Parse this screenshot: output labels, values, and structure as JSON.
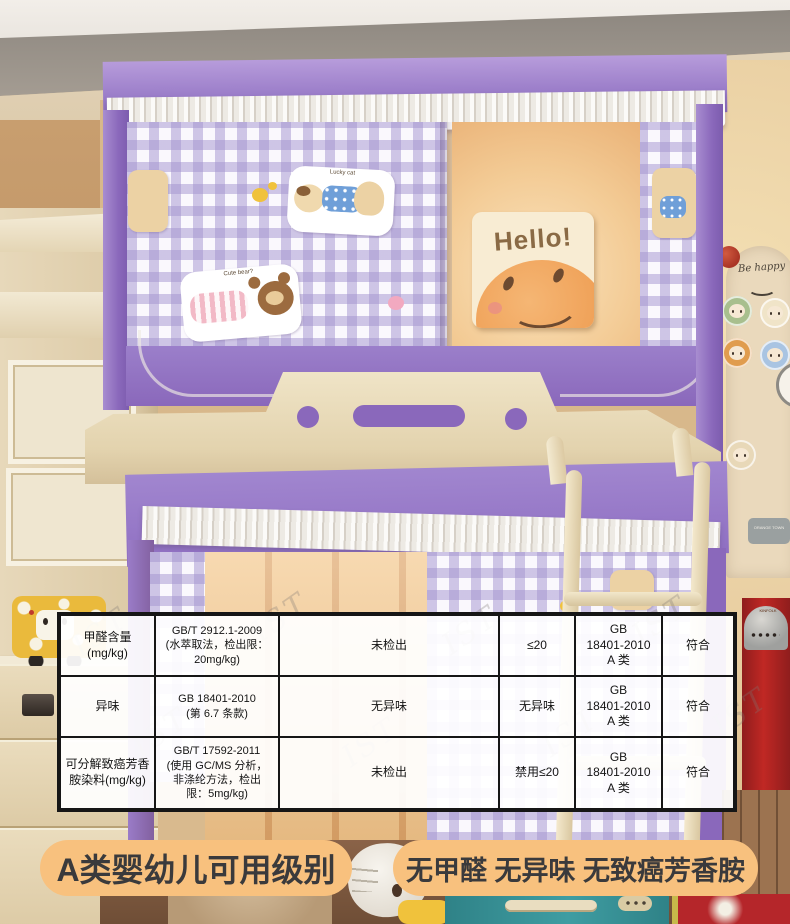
{
  "report_table": {
    "watermark": "IST",
    "rows": [
      {
        "item": "甲醛含量\n(mg/kg)",
        "method": "GB/T 2912.1-2009\n(水萃取法，检出限：\n20mg/kg)",
        "result": "未检出",
        "limit": "≤20",
        "standard": "GB\n18401-2010\nA 类",
        "conclusion": "符合"
      },
      {
        "item": "异味",
        "method": "GB 18401-2010\n(第 6.7 条款)",
        "result": "无异味",
        "limit": "无异味",
        "standard": "GB\n18401-2010\nA 类",
        "conclusion": "符合"
      },
      {
        "item": "可分解致癌芳香\n胺染料(mg/kg)",
        "method": "GB/T 17592-2011\n(使用 GC/MS 分析，\n非涤纶方法，检出\n限：5mg/kg)",
        "result": "未检出",
        "limit": "禁用≤20",
        "standard": "GB\n18401-2010\nA 类",
        "conclusion": "符合"
      }
    ]
  },
  "banners": {
    "left_label": "A类婴幼儿可用级别",
    "right_label": "无甲醛 无异味 无致癌芳香胺"
  },
  "scene_text": {
    "hello_sign": "Hello!",
    "be_happy_sign": "Be happy",
    "orange_town_plaque": "ORANGE TOWN",
    "lucky_cat_sticker": "Lucky cat",
    "cute_bear_sticker": "Cute bear?",
    "kitchen_brand": "KINFOLK"
  },
  "colors": {
    "banner_bg": "#f8c17e",
    "banner_text": "#3a3a3c",
    "canopy_purple": "#9377c5",
    "gingham_lavender": "#b7a9d9",
    "frame_cream": "#ece0c4",
    "table_border": "#161616",
    "suitcase_teal": "#3f9da2"
  }
}
